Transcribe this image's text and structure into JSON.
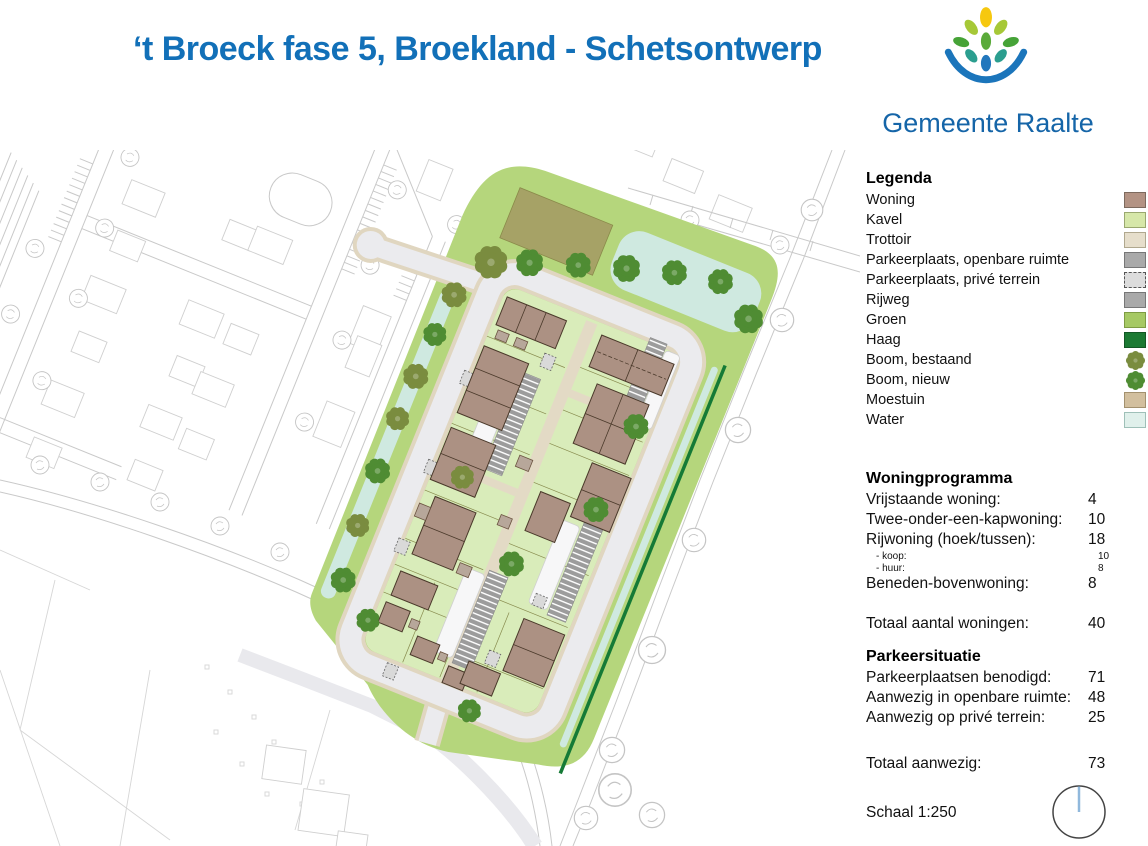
{
  "header": {
    "title": "‘t Broeck fase 5, Broekland - Schetsontwerp",
    "org": "Gemeente Raalte"
  },
  "legend": {
    "title": "Legenda",
    "items": [
      {
        "label": "Woning",
        "swatch": "square",
        "color": "#b39384"
      },
      {
        "label": "Kavel",
        "swatch": "square",
        "color": "#d6e7a9"
      },
      {
        "label": "Trottoir",
        "swatch": "square",
        "color": "#e6decb"
      },
      {
        "label": "Parkeerplaats, openbare ruimte",
        "swatch": "square",
        "color": "#a9a9a9"
      },
      {
        "label": "Parkeerplaats, privé terrein",
        "swatch": "square-dashed",
        "color": "#dcdcdc"
      },
      {
        "label": "Rijweg",
        "swatch": "square",
        "color": "#a9a9a9"
      },
      {
        "label": "Groen",
        "swatch": "square",
        "color": "#a6c964"
      },
      {
        "label": "Haag",
        "swatch": "square",
        "color": "#1c7a33"
      },
      {
        "label": "Boom, bestaand",
        "swatch": "tree",
        "color": "#7a8c3f"
      },
      {
        "label": "Boom, nieuw",
        "swatch": "tree",
        "color": "#4f8c33"
      },
      {
        "label": "Moestuin",
        "swatch": "square",
        "color": "#d2bf9e"
      },
      {
        "label": "Water",
        "swatch": "square",
        "color": "#e0f0eb"
      }
    ]
  },
  "woningprogramma": {
    "title": "Woningprogramma",
    "rows": [
      {
        "label": "Vrijstaande woning:",
        "value": "4"
      },
      {
        "label": "Twee-onder-een-kapwoning:",
        "value": "10"
      },
      {
        "label": "Rijwoning (hoek/tussen):",
        "value": "18"
      },
      {
        "label": "Beneden-bovenwoning:",
        "value": "8"
      }
    ],
    "subrows": [
      {
        "label": "- koop:",
        "value": "10"
      },
      {
        "label": "- huur:",
        "value": "8"
      }
    ],
    "total": {
      "label": "Totaal aantal woningen:",
      "value": "40"
    }
  },
  "parkeersituatie": {
    "title": "Parkeersituatie",
    "rows": [
      {
        "label": "Parkeerplaatsen benodigd:",
        "value": "71"
      },
      {
        "label": "Aanwezig in openbare ruimte:",
        "value": "48"
      },
      {
        "label": "Aanwezig op privé terrein:",
        "value": "25"
      }
    ],
    "total": {
      "label": "Totaal aanwezig:",
      "value": "73"
    }
  },
  "scale": {
    "label": "Schaal 1:250"
  },
  "colors": {
    "title_blue": "#1270b8",
    "logo_blue": "#1b75bb",
    "woning": "#b39384",
    "kavel": "#d6e7a9",
    "trottoir": "#e6decb",
    "parkeer_openbaar": "#a9a9a9",
    "parkeer_prive": "#dcdcdc",
    "rijweg": "#a9a9a9",
    "groen": "#a6c964",
    "haag": "#1c7a33",
    "boom_bestaand": "#7a8c3f",
    "boom_nieuw": "#4f8c33",
    "moestuin": "#d2bf9e",
    "water": "#e0f0eb"
  }
}
